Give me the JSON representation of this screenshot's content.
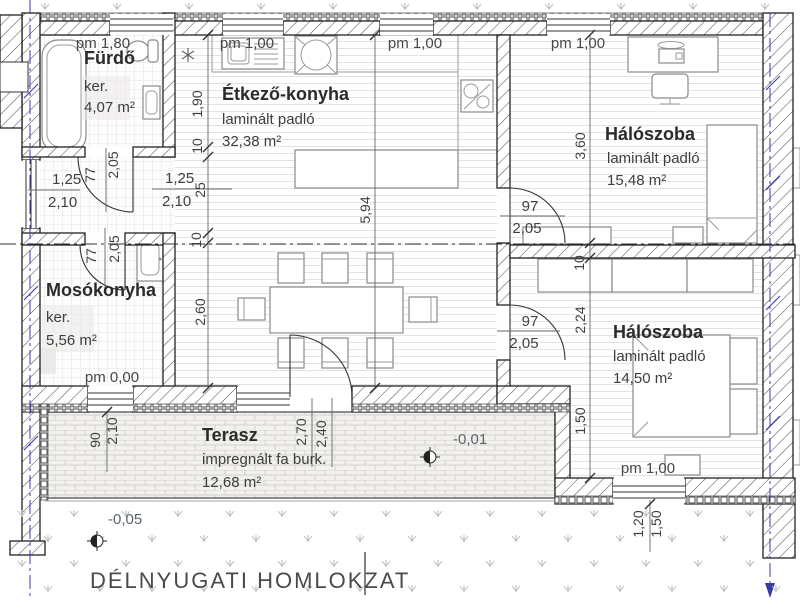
{
  "title": "DÉLNYUGATI HOMLOKZAT",
  "rooms": {
    "furdo": {
      "name": "Fürdő",
      "finish": "ker.",
      "area": "4,07 m²"
    },
    "etkezo_konyha": {
      "name": "Étkező-konyha",
      "finish": "laminált padló",
      "area": "32,38 m²"
    },
    "haloszoba_felso": {
      "name": "Hálószoba",
      "finish": "laminált padló",
      "area": "15,48 m²"
    },
    "mosokonyha": {
      "name": "Mosókonyha",
      "finish": "ker.",
      "area": "5,56 m²"
    },
    "haloszoba_also": {
      "name": "Hálószoba",
      "finish": "laminált padló",
      "area": "14,50 m²"
    },
    "terasz": {
      "name": "Terasz",
      "finish": "impregnált fa burk.",
      "area": "12,68 m²"
    }
  },
  "levels": {
    "pm180": "pm 1,80",
    "pm100_konyha_bal": "pm 1,00",
    "pm100_konyha_jobb": "pm 1,00",
    "pm100_halo_felso": "pm 1,00",
    "pm000_mosokonyha": "pm 0,00",
    "pm100_halo_also": "pm 1,00",
    "terasz_szint": "-0,01",
    "terep_szint": "-0,05"
  },
  "dims": {
    "w125_bal": "1,25",
    "w210_bal": "2,10",
    "w125_kozep": "1,25",
    "w210_kozep": "2,10",
    "v25": "25",
    "v190": "1,90",
    "v10_konyha": "10",
    "v10_also": "10",
    "v260": "2,60",
    "v594": "5,94",
    "v360": "3,60",
    "v10_valaszto": "10",
    "v224": "2,24",
    "v150_halo": "1,50",
    "v120_ablak": "1,20",
    "v150_ablak": "1,50",
    "v90": "90",
    "v210_terasz": "2,10",
    "v270": "2,70",
    "v240": "2,40",
    "d77_furdo": "77",
    "d205_furdo": "2,05",
    "d77_moso": "77",
    "d205_moso": "2,05",
    "d97_felso": "97",
    "d205_felso": "2,05",
    "d97_also": "97",
    "d205_also": "2,05"
  },
  "colors": {
    "wall_line": "#222222",
    "hatch_line": "#555555",
    "blue_accent": "#3b3ba8",
    "grass": "#b9b9b9",
    "brick_fill": "#f2f1ee",
    "brick_line": "#d3d1cd"
  }
}
